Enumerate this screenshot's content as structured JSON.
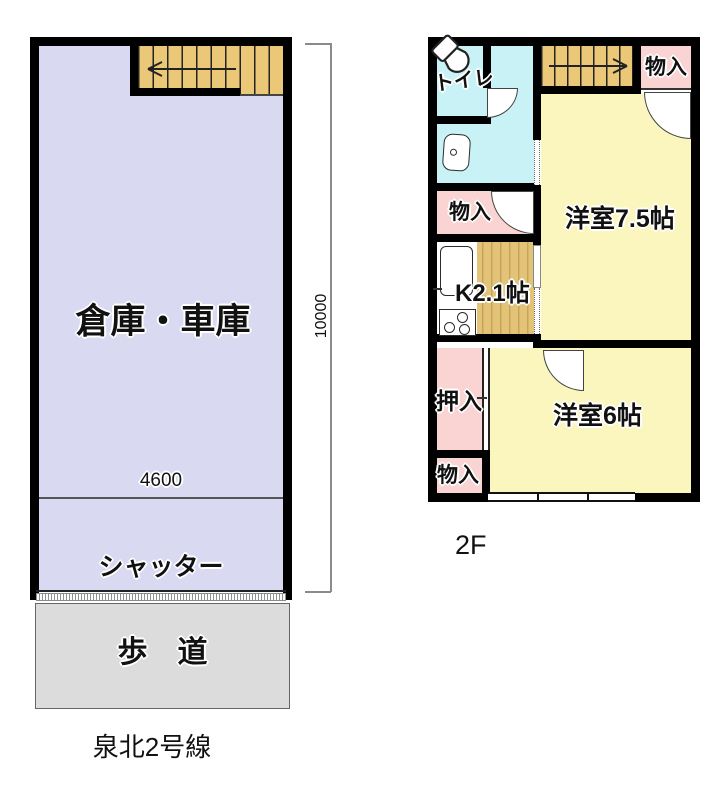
{
  "colors": {
    "wall": "#000000",
    "garage": "#d9d9f2",
    "stairs": "#eac878",
    "water": "#c9f2f7",
    "closet": "#fad3d3",
    "room": "#faf6bd",
    "kitchen_floor": "#e2c378",
    "sidewalk": "#dcdcdc"
  },
  "left_unit": {
    "room_label": "倉庫・車庫",
    "width_dim": "4600",
    "height_dim": "10000",
    "shutter_label": "シャッター",
    "sidewalk_label": "歩　道",
    "road_label": "泉北2号線"
  },
  "right_unit": {
    "floor_label": "2F",
    "toilet_label": "トイレ",
    "storage_top_label": "物入",
    "storage_mid_label": "物入",
    "storage_bottom_label": "物入",
    "room75_label": "洋室7.5帖",
    "kitchen_label": "K2.1帖",
    "oshiire_label": "押入",
    "room6_label": "洋室6帖"
  },
  "icons": {
    "toilet": "toilet-icon",
    "sink": "sink-icon",
    "kitchen_counter": "kitchen-counter-icon",
    "stove": "stove-icon",
    "stairs_left_arrow": "stairs-direction-arrow-left",
    "stairs_right_arrow": "stairs-direction-arrow-right"
  }
}
